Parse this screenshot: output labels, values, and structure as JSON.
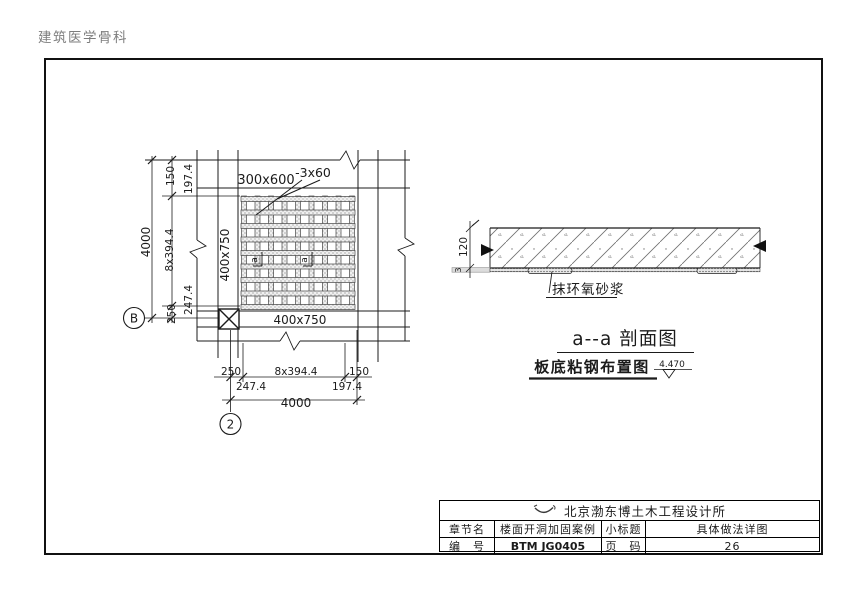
{
  "page": {
    "watermark": "建筑医学骨科"
  },
  "plan": {
    "beam_top_label": "300x600",
    "plate_spec_label": "-3x60",
    "beam_left_label": "400x750",
    "beam_bottom_label": "400x750",
    "section_mark": "a",
    "bubbles": {
      "left": "B",
      "bottom": "2"
    },
    "dim_left": {
      "seg_150": "150",
      "seg_197": "197.4",
      "seg_mid": "8x394.4",
      "seg_247": "247.4",
      "seg_250": "250",
      "total": "4000"
    },
    "dim_bottom": {
      "seg_250": "250",
      "seg_247": "247.4",
      "seg_mid": "8x394.4",
      "seg_197": "197.4",
      "seg_150": "150",
      "total": "4000"
    }
  },
  "section": {
    "thickness_dim": "120",
    "plate_dim": "3",
    "epoxy_label": "抹环氧砂浆",
    "title": "a--a 剖面图",
    "elevation": "4.470"
  },
  "plan_title": "板底粘钢布置图",
  "title_block": {
    "company": "北京渤东博土木工程设计所",
    "row_chapter": {
      "label": "章节名",
      "value": "楼面开洞加固案例",
      "label2": "小标题",
      "value2": "具体做法详图"
    },
    "row_number": {
      "label": "编　号",
      "value": "BTM JG0405",
      "label2": "页　码",
      "value2": "26"
    }
  }
}
